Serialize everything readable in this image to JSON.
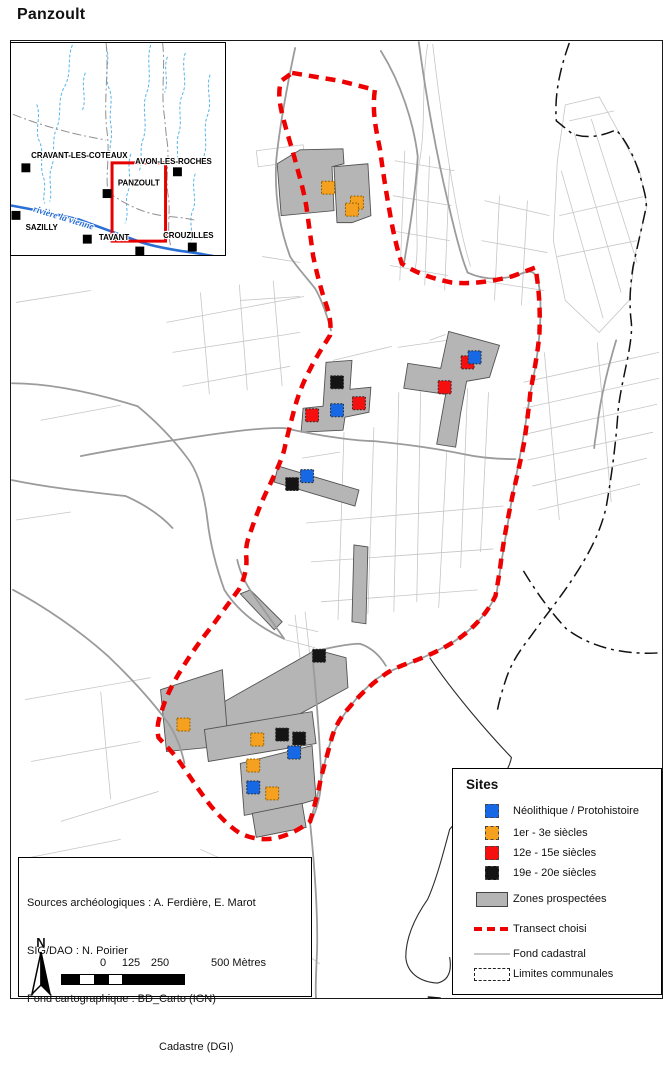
{
  "title": "Panzoult",
  "colors": {
    "site_neolithique": "#1768E4",
    "site_antique": "#F5A01E",
    "site_medieval": "#F50F0F",
    "site_moderne": "#141414",
    "zone_prospectee": "#b5b5b5",
    "transect": "#ee0000",
    "fond_cadastral": "#c6c6c6",
    "riviere": "#2a6fd4"
  },
  "inset": {
    "river_label": {
      "text": "rivière la vienne",
      "x": 22,
      "y": 170,
      "angle": 17
    },
    "towns": [
      {
        "name": "CRAVANT-LES-COTEAUX",
        "sq": [
          15,
          126
        ],
        "label": [
          69,
          116
        ]
      },
      {
        "name": "AVON-LES-ROCHES",
        "sq": [
          168,
          130
        ],
        "label": [
          164,
          122
        ]
      },
      {
        "name": "PANZOULT",
        "sq": [
          97,
          152
        ],
        "label": [
          129,
          144
        ]
      },
      {
        "name": "SAZILLY",
        "sq": [
          5,
          174
        ],
        "label": [
          31,
          189
        ]
      },
      {
        "name": "TAVANT",
        "sq": [
          77,
          198
        ],
        "label": [
          104,
          199
        ]
      },
      {
        "name": "CROUZILLES",
        "sq": [
          183,
          206
        ],
        "label": [
          179,
          197
        ]
      }
    ],
    "extra_squares": [
      [
        130,
        210
      ]
    ],
    "rect": {
      "x": 102,
      "y": 121,
      "w": 54,
      "h": 79
    },
    "river": "M0,164 C22,168 46,173 68,178 C92,187 112,194 131,201 C146,206 160,208 172,210 C182,211 192,213 204,215",
    "streams": [
      "M62,2 C56,16 62,30 54,44 C46,58 52,72 46,86 C40,100 46,114 40,128 C38,140 42,152 39,160",
      "M96,4 C101,18 93,32 99,46 C104,58 98,70 101,84 C103,96 98,108 100,118",
      "M141,2 C136,18 143,34 137,50 C131,66 139,82 133,98 C129,110 134,120 129,130",
      "M176,10 C171,24 179,38 173,52 C167,66 174,78 169,92 C166,104 170,114 167,124",
      "M201,32 C196,46 204,60 198,74 C193,88 200,102 194,116",
      "M26,62 C31,76 23,88 29,100 C34,112 28,124 33,136 C36,148 31,156 34,162",
      "M121,112 C116,126 123,138 118,150 C114,162 120,172 115,182",
      "M186,132 C181,146 189,158 183,170 C179,182 185,192 181,202",
      "M158,14 C153,26 160,38 155,50",
      "M75,30 C70,44 77,56 72,68"
    ],
    "boundaries": [
      "M96,0 C99,30 93,60 97,90 C100,115 95,135 98,150",
      "M153,0 C156,25 151,50 155,75 L157,96",
      "M157,96 C161,116 155,136 159,156 C161,172 157,188 161,204",
      "M2,72 C22,80 42,86 62,91",
      "M97,150 C111,160 126,168 141,172 C156,176 171,175 186,179",
      "M62,91 C74,94 86,96 96,98"
    ]
  },
  "map": {
    "sites": [
      {
        "t": "med",
        "x": 468,
        "y": 362
      },
      {
        "t": "neo",
        "x": 475,
        "y": 357
      },
      {
        "t": "mod",
        "x": 337,
        "y": 382
      },
      {
        "t": "med",
        "x": 445,
        "y": 387
      },
      {
        "t": "med",
        "x": 359,
        "y": 403
      },
      {
        "t": "neo",
        "x": 337,
        "y": 410
      },
      {
        "t": "med",
        "x": 312,
        "y": 415
      },
      {
        "t": "neo",
        "x": 307,
        "y": 476
      },
      {
        "t": "mod",
        "x": 292,
        "y": 484
      },
      {
        "t": "mod",
        "x": 319,
        "y": 656
      },
      {
        "t": "ant",
        "x": 328,
        "y": 187
      },
      {
        "t": "ant",
        "x": 357,
        "y": 202
      },
      {
        "t": "ant",
        "x": 352,
        "y": 209
      },
      {
        "t": "ant",
        "x": 183,
        "y": 725
      },
      {
        "t": "mod",
        "x": 282,
        "y": 735
      },
      {
        "t": "mod",
        "x": 299,
        "y": 739
      },
      {
        "t": "ant",
        "x": 257,
        "y": 740
      },
      {
        "t": "neo",
        "x": 294,
        "y": 753
      },
      {
        "t": "ant",
        "x": 253,
        "y": 766
      },
      {
        "t": "neo",
        "x": 253,
        "y": 788
      },
      {
        "t": "ant",
        "x": 272,
        "y": 794
      }
    ],
    "zones": [
      "277,163 300,149 343,148 344,163 332,166 334,210 281,215",
      "334,166 368,163 371,215 352,222 337,222",
      "449,331 500,345 490,377 467,381 461,413 456,447 437,444 446,394 404,388 408,363 441,368",
      "326,362 352,360 350,389 371,387 369,412 345,417 343,430 301,432 303,408 323,406",
      "278,466 359,490 355,506 274,482",
      "354,545 368,547 366,624 352,622",
      "240,594 250,590 282,622 274,630",
      "224,702 316,650 346,658 348,688 260,736 227,740",
      "160,690 222,670 228,746 166,752",
      "204,730 312,712 316,744 208,762",
      "240,764 312,746 316,800 296,806 244,816",
      "252,814 302,804 306,828 256,838"
    ],
    "layers": {
      "transect": "M292,72 L340,80 L375,89 C372,110 376,128 380,148 C383,170 386,190 390,212 C393,230 397,248 402,263 C415,272 432,278 452,282 C470,284 492,281 512,276 C521,273 530,269 536,267 C540,290 541,312 540,334 C538,356 534,374 531,392 C529,411 527,426 525,441 C521,462 517,478 513,496 C508,520 504,541 501,565 C499,580 497,590 496,596 C488,613 474,629 456,641 C440,651 424,658 407,664 C396,668 388,672 382,677 C371,685 360,695 350,707 C340,718 334,729 331,741 C327,757 322,772 319,788 C316,800 313,812 310,822 C300,830 288,836 275,839 C262,841 250,839 240,834 C230,828 220,818 210,806 C200,793 190,778 181,765 C173,753 164,745 158,738 C156,730 157,722 161,712 C165,698 172,684 182,668 C192,652 202,638 212,626 C222,612 231,600 239,589 C244,579 247,568 246,557 C245,548 247,540 251,530 C256,515 262,500 269,486 C275,473 281,461 284,450 C287,436 291,421 295,406 C299,392 304,380 310,369 C316,357 323,346 330,335 C332,321 328,309 324,298 C320,285 316,270 313,255 C311,240 309,226 307,211 C305,196 301,181 297,167 C293,151 288,136 284,121 C280,106 277,93 281,80 Z",
      "boundary": [
        "M570,42 C560,70 555,95 557,120 L573,133 C590,139 605,134 617,129 C628,141 636,158 641,175 C645,190 648,199 647,207 C643,226 638,247 634,266 C631,285 630,303 632,320 C635,341 622,380 619,410 C617,440 613,473 607,507 C600,538 584,563 570,584 C557,603 543,620 531,637 C521,650 513,661 507,678 C503,690 500,700 498,710",
        "M524,571 C538,594 552,613 567,629 C588,645 620,656 662,653",
        "M428,998 C470,1002 510,1004 546,1001"
      ],
      "roads": [
        "M419,41 C427,100 436,150 448,200 C456,235 462,258 468,272",
        "M80,456 C120,448 160,442 200,436 C240,430 270,427 285,428 C325,437 360,441 374,441 C405,444 440,449 464,454 C482,458 500,459 516,459",
        "M295,47 C288,80 280,120 276,160 C274,200 281,232 290,256 C296,266 305,275 315,288 C322,300 327,315 331,330",
        "M381,50 C401,82 414,122 418,156 C416,192 410,228 404,264",
        "M468,272 C485,280 505,280 525,272 C536,268 540,276 541,300 C542,330 538,360 531,392 C527,420 522,450 514,490 C508,525 502,560 497,594 C488,614 472,630 454,642 C436,652 420,660 404,666 C390,671 380,676 372,683 C360,694 350,706 342,718 C334,730 329,745 325,762 C321,782 316,802 310,823",
        "M11,383 C50,383 95,393 137,406 C160,425 175,442 187,458 C198,472 204,495 207,520 C210,545 216,568 224,590 C238,612 260,628 284,639",
        "M11,480 C50,488 90,492 125,496 C145,505 160,515 172,528",
        "M12,590 C42,606 78,630 108,657 C132,680 152,702 168,724 C176,736 181,750 184,764",
        "M312,652 C316,692 319,732 321,772 C322,792 318,808 311,822",
        "M284,639 C272,622 261,606 251,592 C244,581 239,570 237,560",
        "M310,823 C314,862 318,912 317,952 C316,975 315,990 316,999",
        "M312,652 C330,648 348,644 360,644 C372,648 380,656 386,666",
        "M617,340 C608,370 601,400 598,426 C596,440 595,445 595,448"
      ],
      "streams": [
        "M430,658 C455,695 490,735 512,758 C505,790 470,805 450,830 C442,860 436,882 428,900 C414,920 406,940 406,958 C407,973 419,983 438,984 C450,981 452,970 450,958"
      ],
      "cadastral": [
        "M566,104 L600,96 L640,168 L648,205 L637,250 L630,300 L600,332 L566,300 L554,240 L558,160 Z",
        "M575,132 L622,292",
        "M592,118 L638,262",
        "M562,170 L604,318",
        "M560,215 L644,196",
        "M558,256 L638,240",
        "M570,120 L615,110",
        "M524,382 L660,352",
        "M524,408 L660,378",
        "M526,434 L658,404",
        "M528,460 L654,432",
        "M533,486 L648,458",
        "M539,510 L641,484",
        "M545,352 L560,520",
        "M598,342 L612,502",
        "M344,432 L338,620",
        "M374,427 L368,614",
        "M399,392 L394,612",
        "M421,388 L417,602",
        "M447,452 L439,608",
        "M468,388 L461,568",
        "M489,392 L481,552",
        "M306,523 L504,506",
        "M311,562 L494,549",
        "M321,602 L478,590",
        "M333,360 L392,346",
        "M398,347 L468,337",
        "M302,458 L340,452",
        "M430,340 L446,334",
        "M166,322 L304,296",
        "M172,352 L300,332",
        "M182,386 L290,366",
        "M200,292 L209,394",
        "M239,284 L247,390",
        "M273,280 L282,386",
        "M15,302 L90,290",
        "M40,420 L120,405",
        "M15,520 L70,512",
        "M256,150 L303,144 L305,160 L258,166 Z",
        "M262,256 L300,262",
        "M240,300 L300,296",
        "M24,700 L150,678",
        "M30,762 L140,742",
        "M60,822 L158,792",
        "M100,692 L110,800",
        "M20,860 L120,840",
        "M200,850 L280,886",
        "M230,880 L300,920",
        "M270,930 L320,965",
        "M180,900 L250,950",
        "M395,160 L455,170",
        "M393,195 L452,205",
        "M391,230 L450,240",
        "M390,265 L448,275",
        "M405,150 L400,280",
        "M430,155 L425,285",
        "M450,165 L445,290",
        "M485,200 L550,215",
        "M482,240 L548,252",
        "M480,280 L545,290",
        "M500,195 L495,300",
        "M528,200 L522,305",
        "M288,625 L318,632",
        "M295,615 L300,660",
        "M305,612 L310,658",
        "M285,640 L315,648",
        "M428,43 C421,85 427,125 419,165 C413,205 421,245 415,270",
        "M433,43 C439,95 446,145 454,190 C460,225 466,250 471,266"
      ]
    }
  },
  "legend": {
    "title": "Sites",
    "items": [
      {
        "swatch": "square",
        "color": "#1768E4",
        "label": "Néolithique / Protohistoire",
        "top": 33
      },
      {
        "swatch": "square",
        "color": "#F5A01E",
        "label": "1er - 3e siècles",
        "top": 55
      },
      {
        "swatch": "square",
        "color": "#F50F0F",
        "label": "12e - 15e siècles",
        "top": 75
      },
      {
        "swatch": "square",
        "color": "#141414",
        "label": "19e - 20e siècles",
        "top": 95
      },
      {
        "swatch": "zone",
        "color": "#b5b5b5",
        "label": "Zones prospectées",
        "top": 121
      },
      {
        "swatch": "transect",
        "color": "#ee0000",
        "label": "Transect choisi",
        "top": 151
      },
      {
        "swatch": "line",
        "color": "#c9c9c9",
        "label": "Fond cadastral",
        "top": 176
      },
      {
        "swatch": "dashdot",
        "color": "#222222",
        "label": "Limites communales",
        "top": 196
      }
    ]
  },
  "sources": {
    "lines": [
      "Sources archéologiques : A. Ferdière, E. Marot",
      "SIG/DAO : N. Poirier",
      "Fond cartographique : BD_Carto (IGN)",
      "Cadastre (DGI)"
    ]
  },
  "north_label": "N",
  "scalebar": {
    "labels": [
      {
        "text": "0",
        "x": 42
      },
      {
        "text": "125",
        "x": 70
      },
      {
        "text": "250",
        "x": 99
      },
      {
        "text": "500 Mètres",
        "x": 150,
        "align": "left"
      }
    ],
    "segments": [
      {
        "w": 18,
        "c": "#000000"
      },
      {
        "w": 14,
        "c": "#ffffff"
      },
      {
        "w": 15,
        "c": "#000000"
      },
      {
        "w": 13,
        "c": "#ffffff"
      },
      {
        "w": 62,
        "c": "#000000"
      }
    ]
  }
}
